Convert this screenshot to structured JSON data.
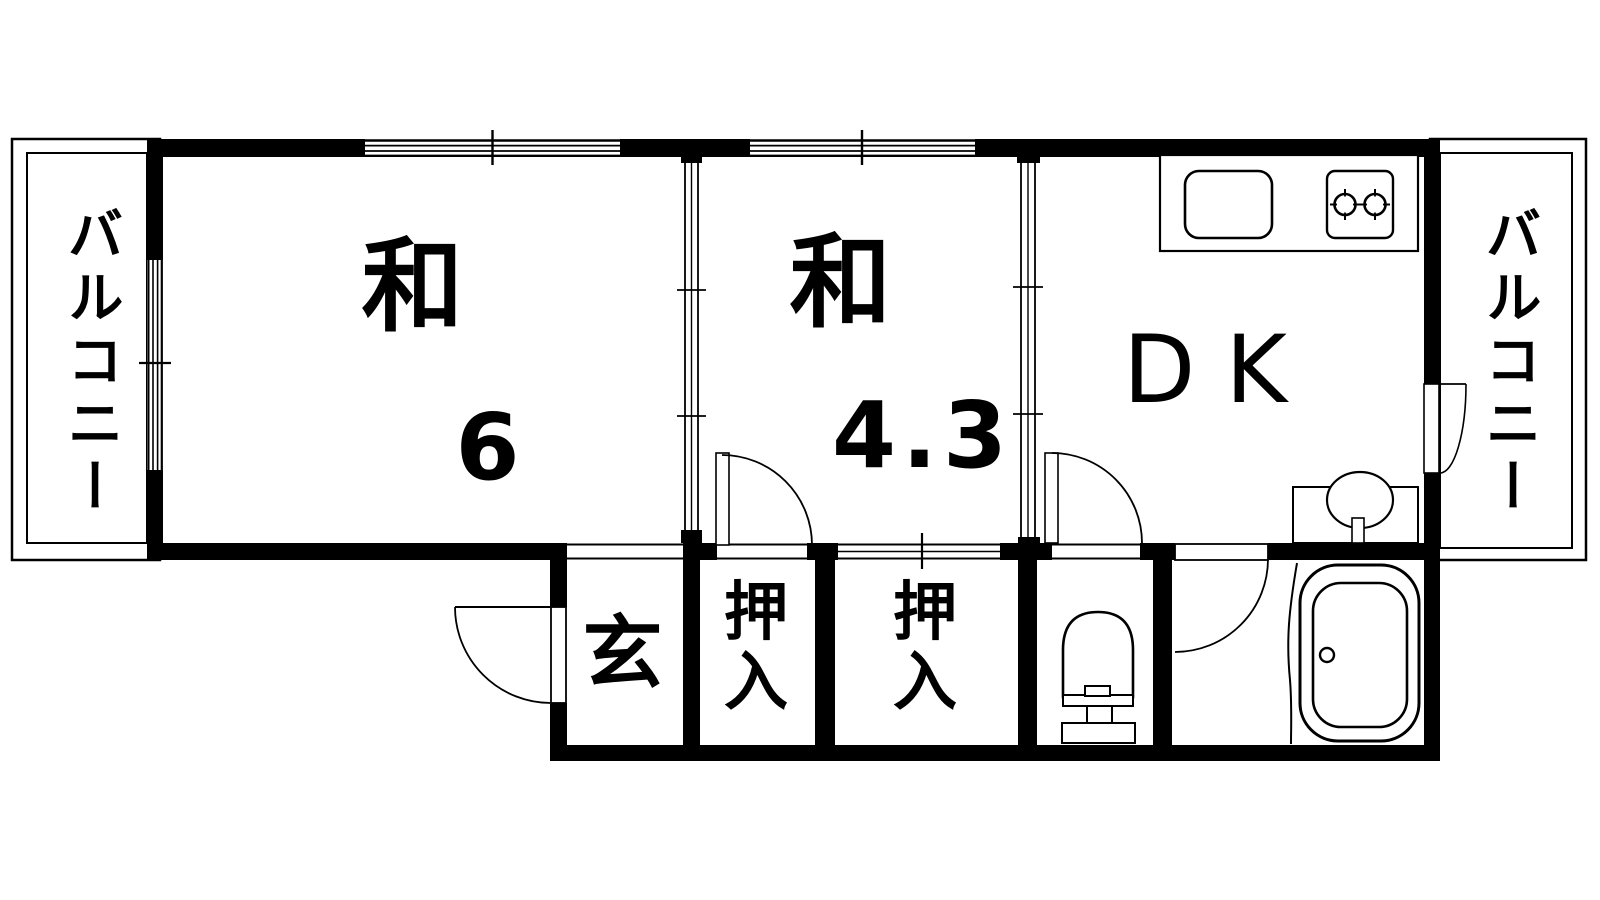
{
  "page": {
    "background": "#ffffff",
    "ink": "#000000",
    "type": "apartment floor plan (2DK)"
  },
  "plan": {
    "balcony_left": "バルコニー",
    "balcony_right": "バルコニー",
    "room1": {
      "name": "和",
      "size": "6"
    },
    "room2": {
      "name": "和",
      "size": "4.3"
    },
    "dk": "DK",
    "genkan": "玄",
    "closet1": "押入",
    "closet2": "押入",
    "fixtures": [
      "kitchen-sink",
      "gas-stove-2-burner",
      "washbasin",
      "toilet",
      "bathtub"
    ]
  }
}
